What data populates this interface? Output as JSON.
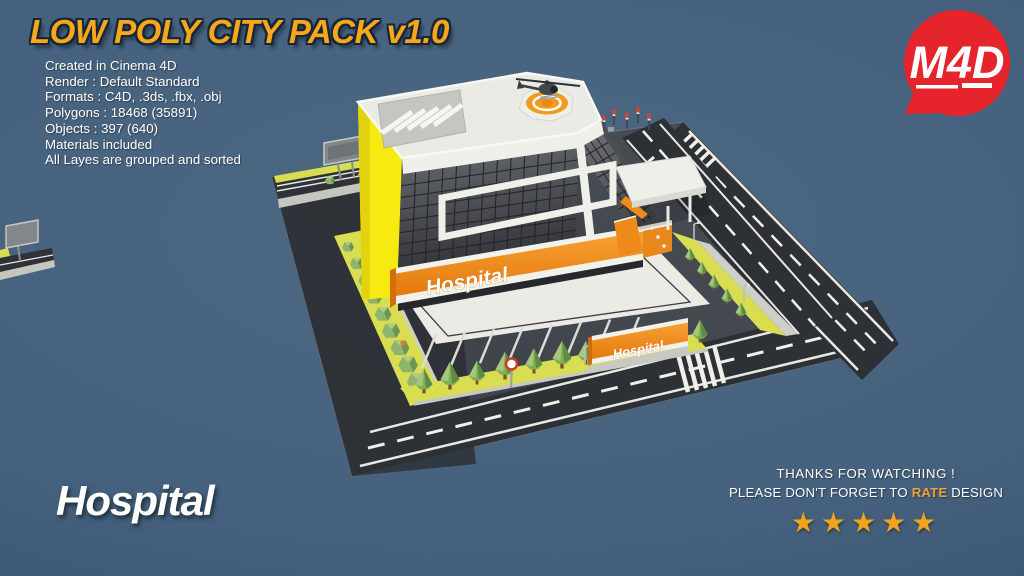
{
  "title": "LOW POLY CITY PACK v1.0",
  "specs": [
    "Created in Cinema 4D",
    "Render : Default Standard",
    "Formats : C4D, .3ds, .fbx, .obj",
    "Polygons : 18468 (35891)",
    "Objects : 397 (640)",
    "Materials included",
    "All Layes are grouped and sorted"
  ],
  "logo": {
    "text": "M4D"
  },
  "scene": {
    "building_sign": "Hospital",
    "parking_sign": "Hospital"
  },
  "model_label": "Hospital",
  "footer": {
    "line1": "THANKS FOR WATCHING !",
    "line2_prefix": "PLEASE DON'T FORGET TO ",
    "line2_highlight": "RATE",
    "line2_suffix": " DESIGN",
    "stars": "★★★★★"
  },
  "colors": {
    "accent_orange": "#ef8c1e",
    "building_yellow": "#f6e912",
    "logo_red": "#e5242b",
    "star_gold": "#f2a41d",
    "bg_center": "#4c6783",
    "bg_edge": "#35506b"
  }
}
